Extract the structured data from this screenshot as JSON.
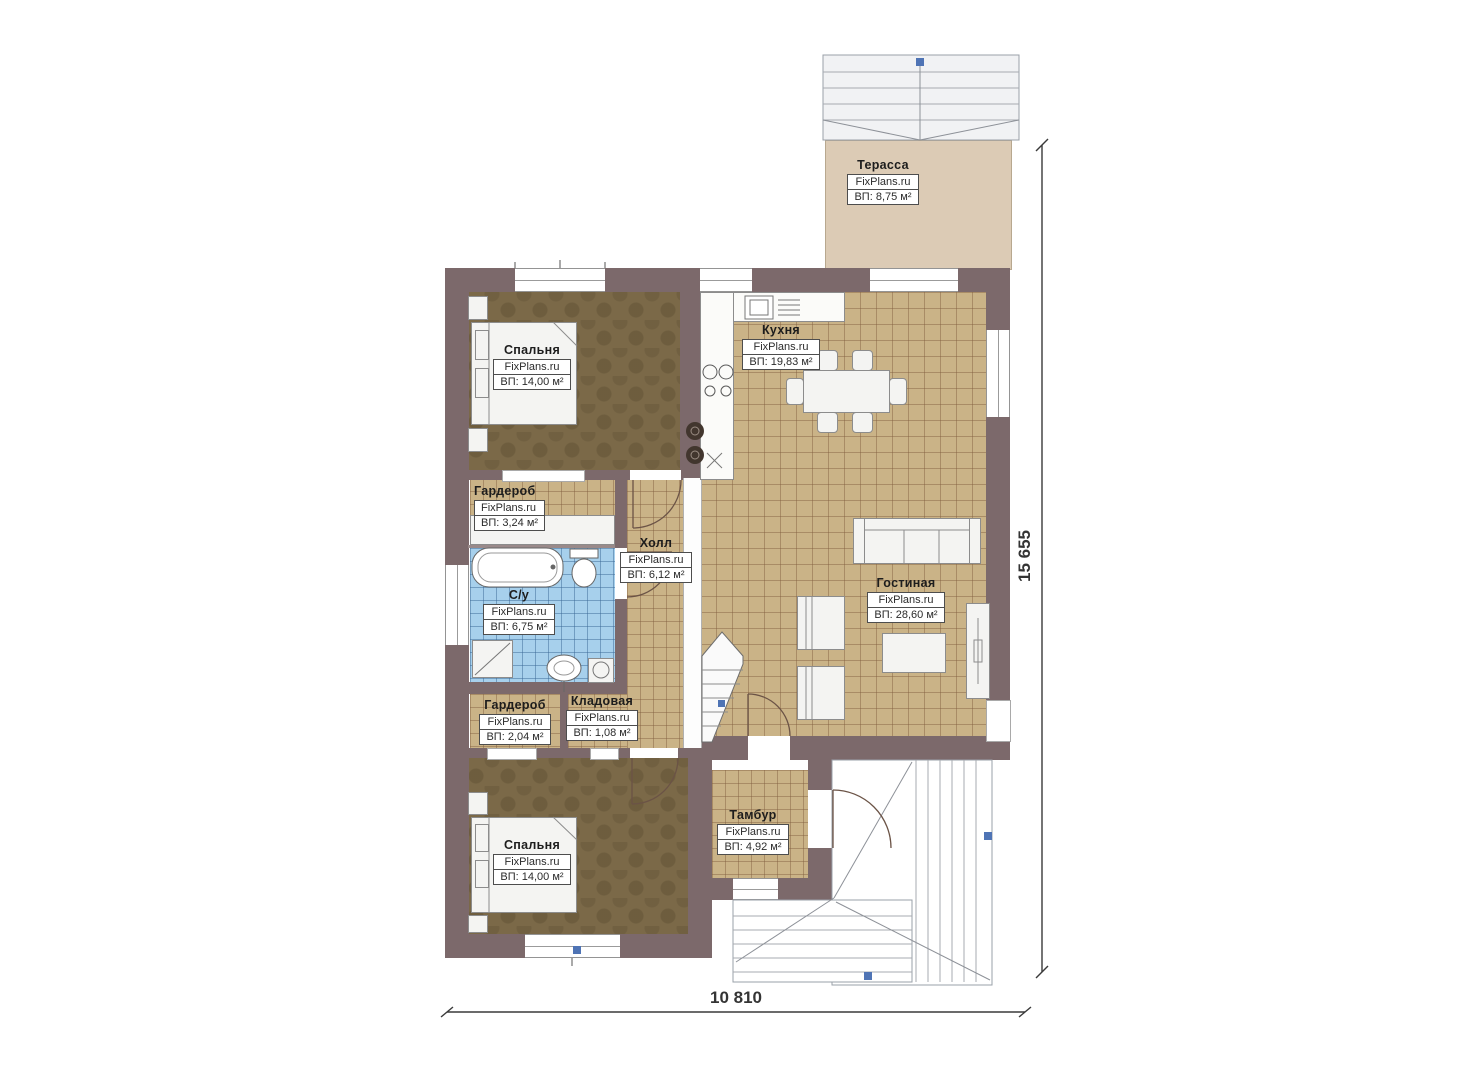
{
  "plan": {
    "type": "floor-plan",
    "branding": "FixPlans.ru"
  },
  "rooms": [
    {
      "id": "terrace",
      "name": "Терасса",
      "brand": "FixPlans.ru",
      "area": "ВП: 8,75 м²"
    },
    {
      "id": "bedroom1",
      "name": "Спальня",
      "brand": "FixPlans.ru",
      "area": "ВП: 14,00 м²"
    },
    {
      "id": "kitchen",
      "name": "Кухня",
      "brand": "FixPlans.ru",
      "area": "ВП: 19,83 м²"
    },
    {
      "id": "wardrobe1",
      "name": "Гардероб",
      "brand": "FixPlans.ru",
      "area": "ВП: 3,24 м²"
    },
    {
      "id": "hall",
      "name": "Холл",
      "brand": "FixPlans.ru",
      "area": "ВП: 6,12 м²"
    },
    {
      "id": "bathroom",
      "name": "С/у",
      "brand": "FixPlans.ru",
      "area": "ВП: 6,75 м²"
    },
    {
      "id": "wardrobe2",
      "name": "Гардероб",
      "brand": "FixPlans.ru",
      "area": "ВП: 2,04 м²"
    },
    {
      "id": "storage",
      "name": "Кладовая",
      "brand": "FixPlans.ru",
      "area": "ВП: 1,08 м²"
    },
    {
      "id": "living",
      "name": "Гостиная",
      "brand": "FixPlans.ru",
      "area": "ВП: 28,60 м²"
    },
    {
      "id": "bedroom2",
      "name": "Спальня",
      "brand": "FixPlans.ru",
      "area": "ВП: 14,00 м²"
    },
    {
      "id": "tambur",
      "name": "Тамбур",
      "brand": "FixPlans.ru",
      "area": "ВП: 4,92 м²"
    }
  ],
  "dimensions": {
    "width_label": "10 810",
    "height_label": "15 655"
  },
  "colors": {
    "wall": "#7c696b",
    "tile_floor": "#cab387",
    "bath_floor": "#a7d0ec",
    "bedroom_floor": "#7b6948",
    "terrace_floor": "#dccbb5",
    "porch_floor": "#e7d8c1",
    "marker_blue": "#4f74b5"
  }
}
